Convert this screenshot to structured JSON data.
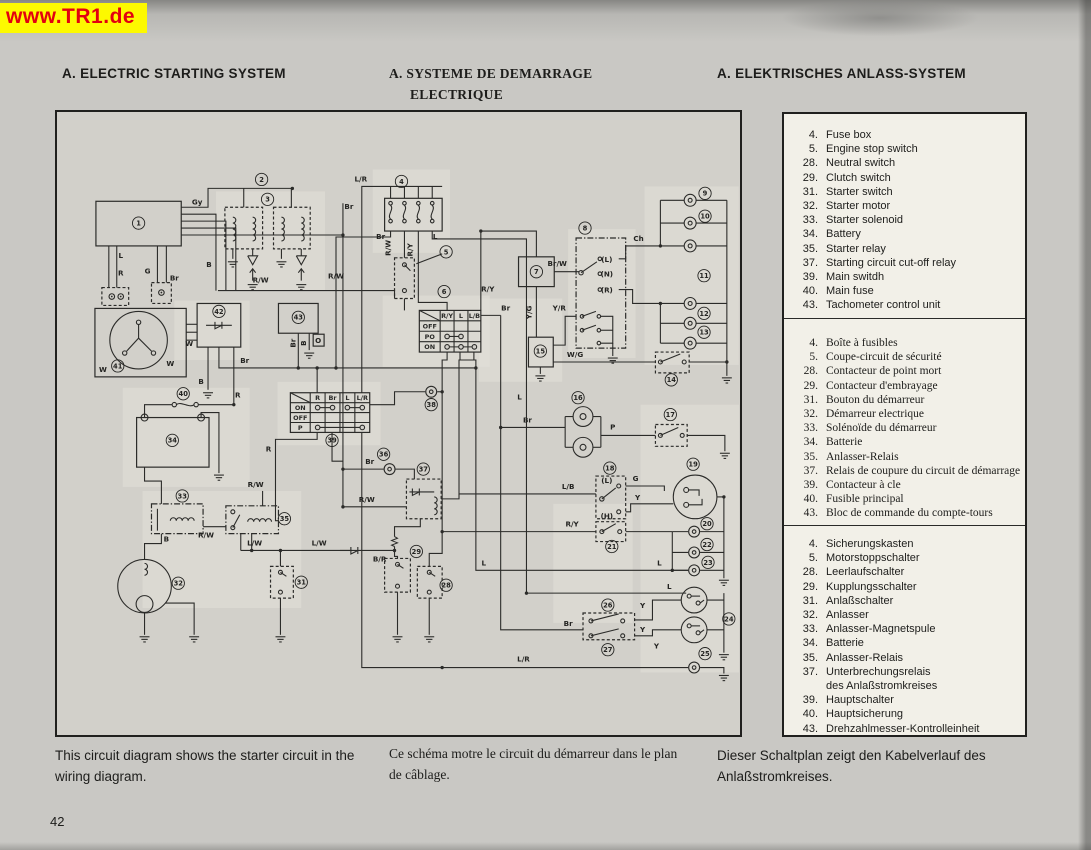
{
  "banner": {
    "text": "www.TR1.de"
  },
  "headers": {
    "english": "A.  ELECTRIC STARTING SYSTEM",
    "french_line1": "A.  SYSTEME DE DEMARRAGE",
    "french_line2": "ELECTRIQUE",
    "german": "A.  ELEKTRISCHES ANLASS-SYSTEM"
  },
  "legend": {
    "english": {
      "items": [
        {
          "num": "4.",
          "label": "Fuse box"
        },
        {
          "num": "5.",
          "label": "Engine stop switch"
        },
        {
          "num": "28.",
          "label": "Neutral switch"
        },
        {
          "num": "29.",
          "label": "Clutch switch"
        },
        {
          "num": "31.",
          "label": "Starter switch"
        },
        {
          "num": "32.",
          "label": "Starter motor"
        },
        {
          "num": "33.",
          "label": "Starter solenoid"
        },
        {
          "num": "34.",
          "label": "Battery"
        },
        {
          "num": "35.",
          "label": "Starter relay"
        },
        {
          "num": "37.",
          "label": "Starting circuit cut-off relay"
        },
        {
          "num": "39.",
          "label": "Main switdh"
        },
        {
          "num": "40.",
          "label": "Main fuse"
        },
        {
          "num": "43.",
          "label": "Tachometer control unit"
        }
      ]
    },
    "french": {
      "items": [
        {
          "num": "4.",
          "label": "Boîte à fusibles"
        },
        {
          "num": "5.",
          "label": "Coupe-circuit de sécurité"
        },
        {
          "num": "28.",
          "label": "Contacteur de point mort"
        },
        {
          "num": "29.",
          "label": "Contacteur d'embrayage"
        },
        {
          "num": "31.",
          "label": "Bouton du démarreur"
        },
        {
          "num": "32.",
          "label": "Démarreur electrique"
        },
        {
          "num": "33.",
          "label": "Solénoïde du démarreur"
        },
        {
          "num": "34.",
          "label": "Batterie"
        },
        {
          "num": "35.",
          "label": "Anlasser-Relais"
        },
        {
          "num": "37.",
          "label": "Relais de coupure du circuit de démarrage"
        },
        {
          "num": "39.",
          "label": "Contacteur à cle"
        },
        {
          "num": "40.",
          "label": "Fusible principal"
        },
        {
          "num": "43.",
          "label": "Bloc de commande du compte-tours"
        }
      ]
    },
    "german": {
      "items": [
        {
          "num": "4.",
          "label": "Sicherungskasten"
        },
        {
          "num": "5.",
          "label": "Motorstoppschalter"
        },
        {
          "num": "28.",
          "label": "Leerlaufschalter"
        },
        {
          "num": "29.",
          "label": "Kupplungsschalter"
        },
        {
          "num": "31.",
          "label": "Anlaßschalter"
        },
        {
          "num": "32.",
          "label": "Anlasser"
        },
        {
          "num": "33.",
          "label": "Anlasser-Magnetspule"
        },
        {
          "num": "34.",
          "label": "Batterie"
        },
        {
          "num": "35.",
          "label": "Anlasser-Relais"
        },
        {
          "num": "37.",
          "label": "Unterbrechungsrelais"
        },
        {
          "num": "",
          "label": "des Anlaßstromkreises"
        },
        {
          "num": "39.",
          "label": "Hauptschalter"
        },
        {
          "num": "40.",
          "label": "Hauptsicherung"
        },
        {
          "num": "43.",
          "label": "Drehzahlmesser-Kontrolleinheit"
        }
      ]
    }
  },
  "captions": {
    "english": "This circuit diagram shows the starter circuit in the wiring diagram.",
    "french": "Ce schéma motre le circuit du démarreur dans le plan de câblage.",
    "german": "Dieser Schaltplan zeigt den Kabelverlauf des Anlaßstromkreises."
  },
  "page_number": "42",
  "diagram": {
    "tables": {
      "handlebar": {
        "cols": [
          "R/Y",
          "L",
          "L/B"
        ],
        "rows": [
          "OFF",
          "PO",
          "ON"
        ]
      },
      "main": {
        "cols": [
          "R",
          "Br",
          "L",
          "L/R"
        ],
        "rows": [
          "ON",
          "OFF",
          "P"
        ]
      }
    },
    "wire_labels": [
      {
        "t": "Gy",
        "x": 141,
        "y": 93
      },
      {
        "t": "L",
        "x": 64,
        "y": 147
      },
      {
        "t": "R",
        "x": 64,
        "y": 165
      },
      {
        "t": "G",
        "x": 91,
        "y": 163
      },
      {
        "t": "Br",
        "x": 118,
        "y": 170
      },
      {
        "t": "B",
        "x": 153,
        "y": 156
      },
      {
        "t": "W",
        "x": 46,
        "y": 262
      },
      {
        "t": "W",
        "x": 114,
        "y": 256
      },
      {
        "t": "W",
        "x": 133,
        "y": 236
      },
      {
        "t": "B",
        "x": 145,
        "y": 274
      },
      {
        "t": "R",
        "x": 182,
        "y": 288
      },
      {
        "t": "Br",
        "x": 189,
        "y": 253
      },
      {
        "t": "R/W",
        "x": 205,
        "y": 172
      },
      {
        "t": "R/W",
        "x": 281,
        "y": 168
      },
      {
        "t": "Br",
        "x": 294,
        "y": 98
      },
      {
        "t": "L/R",
        "x": 306,
        "y": 70
      },
      {
        "t": "Br",
        "x": 326,
        "y": 128
      },
      {
        "t": "R/W",
        "x": 336,
        "y": 137,
        "v": 1
      },
      {
        "t": "R/Y",
        "x": 358,
        "y": 139,
        "v": 1
      },
      {
        "t": "L",
        "x": 381,
        "y": 128
      },
      {
        "t": "R/Y",
        "x": 434,
        "y": 181
      },
      {
        "t": "L",
        "x": 466,
        "y": 290
      },
      {
        "t": "Br/W",
        "x": 504,
        "y": 155
      },
      {
        "t": "Ch",
        "x": 586,
        "y": 130
      },
      {
        "t": "(L)",
        "x": 554,
        "y": 151
      },
      {
        "t": "(N)",
        "x": 554,
        "y": 166
      },
      {
        "t": "(R)",
        "x": 554,
        "y": 182
      },
      {
        "t": "Y/G",
        "x": 478,
        "y": 202,
        "v": 1
      },
      {
        "t": "Br",
        "x": 452,
        "y": 200
      },
      {
        "t": "Y/R",
        "x": 506,
        "y": 200
      },
      {
        "t": "W/G",
        "x": 522,
        "y": 247
      },
      {
        "t": "Br",
        "x": 474,
        "y": 313
      },
      {
        "t": "P",
        "x": 560,
        "y": 320
      },
      {
        "t": "L/B",
        "x": 515,
        "y": 380
      },
      {
        "t": "G",
        "x": 583,
        "y": 372
      },
      {
        "t": "Y",
        "x": 585,
        "y": 391
      },
      {
        "t": "(L)",
        "x": 554,
        "y": 374
      },
      {
        "t": "(H)",
        "x": 554,
        "y": 410
      },
      {
        "t": "R/Y",
        "x": 519,
        "y": 418
      },
      {
        "t": "L",
        "x": 430,
        "y": 457
      },
      {
        "t": "L",
        "x": 607,
        "y": 457
      },
      {
        "t": "L",
        "x": 617,
        "y": 481
      },
      {
        "t": "Y",
        "x": 590,
        "y": 500
      },
      {
        "t": "Y",
        "x": 590,
        "y": 524
      },
      {
        "t": "Y",
        "x": 604,
        "y": 541
      },
      {
        "t": "L/R",
        "x": 470,
        "y": 554
      },
      {
        "t": "Br",
        "x": 515,
        "y": 518
      },
      {
        "t": "R",
        "x": 213,
        "y": 342
      },
      {
        "t": "Br",
        "x": 315,
        "y": 355
      },
      {
        "t": "R/W",
        "x": 312,
        "y": 393
      },
      {
        "t": "B/R",
        "x": 325,
        "y": 453
      },
      {
        "t": "L/W",
        "x": 199,
        "y": 437
      },
      {
        "t": "L/W",
        "x": 264,
        "y": 437
      },
      {
        "t": "B",
        "x": 110,
        "y": 433
      },
      {
        "t": "R/W",
        "x": 150,
        "y": 429
      },
      {
        "t": "R/W",
        "x": 200,
        "y": 378
      },
      {
        "t": "Br",
        "x": 240,
        "y": 233,
        "v": 1
      },
      {
        "t": "B",
        "x": 251,
        "y": 233,
        "v": 1
      },
      {
        "t": "O",
        "x": 263,
        "y": 233
      }
    ],
    "callouts": [
      {
        "n": "1",
        "x": 82,
        "y": 112
      },
      {
        "n": "2",
        "x": 206,
        "y": 68
      },
      {
        "n": "3",
        "x": 212,
        "y": 88
      },
      {
        "n": "4",
        "x": 347,
        "y": 70
      },
      {
        "n": "5",
        "x": 392,
        "y": 141
      },
      {
        "n": "6",
        "x": 390,
        "y": 181
      },
      {
        "n": "7",
        "x": 483,
        "y": 161
      },
      {
        "n": "8",
        "x": 532,
        "y": 117
      },
      {
        "n": "9",
        "x": 653,
        "y": 82
      },
      {
        "n": "10",
        "x": 653,
        "y": 105
      },
      {
        "n": "11",
        "x": 652,
        "y": 165
      },
      {
        "n": "12",
        "x": 652,
        "y": 203
      },
      {
        "n": "13",
        "x": 652,
        "y": 222
      },
      {
        "n": "14",
        "x": 619,
        "y": 270
      },
      {
        "n": "15",
        "x": 487,
        "y": 241
      },
      {
        "n": "16",
        "x": 525,
        "y": 288
      },
      {
        "n": "17",
        "x": 618,
        "y": 305
      },
      {
        "n": "18",
        "x": 557,
        "y": 359
      },
      {
        "n": "19",
        "x": 641,
        "y": 355
      },
      {
        "n": "20",
        "x": 655,
        "y": 415
      },
      {
        "n": "21",
        "x": 559,
        "y": 438
      },
      {
        "n": "22",
        "x": 655,
        "y": 436
      },
      {
        "n": "23",
        "x": 656,
        "y": 454
      },
      {
        "n": "24",
        "x": 677,
        "y": 511
      },
      {
        "n": "25",
        "x": 653,
        "y": 546
      },
      {
        "n": "26",
        "x": 555,
        "y": 497
      },
      {
        "n": "27",
        "x": 555,
        "y": 542
      },
      {
        "n": "28",
        "x": 392,
        "y": 477
      },
      {
        "n": "29",
        "x": 362,
        "y": 443
      },
      {
        "n": "31",
        "x": 246,
        "y": 474
      },
      {
        "n": "32",
        "x": 122,
        "y": 475
      },
      {
        "n": "33",
        "x": 126,
        "y": 387
      },
      {
        "n": "34",
        "x": 116,
        "y": 331
      },
      {
        "n": "35",
        "x": 229,
        "y": 410
      },
      {
        "n": "36",
        "x": 329,
        "y": 345
      },
      {
        "n": "37",
        "x": 369,
        "y": 360
      },
      {
        "n": "38",
        "x": 377,
        "y": 295
      },
      {
        "n": "39",
        "x": 277,
        "y": 331
      },
      {
        "n": "40",
        "x": 127,
        "y": 284
      },
      {
        "n": "41",
        "x": 61,
        "y": 256
      },
      {
        "n": "42",
        "x": 163,
        "y": 201
      },
      {
        "n": "43",
        "x": 243,
        "y": 207
      }
    ]
  }
}
